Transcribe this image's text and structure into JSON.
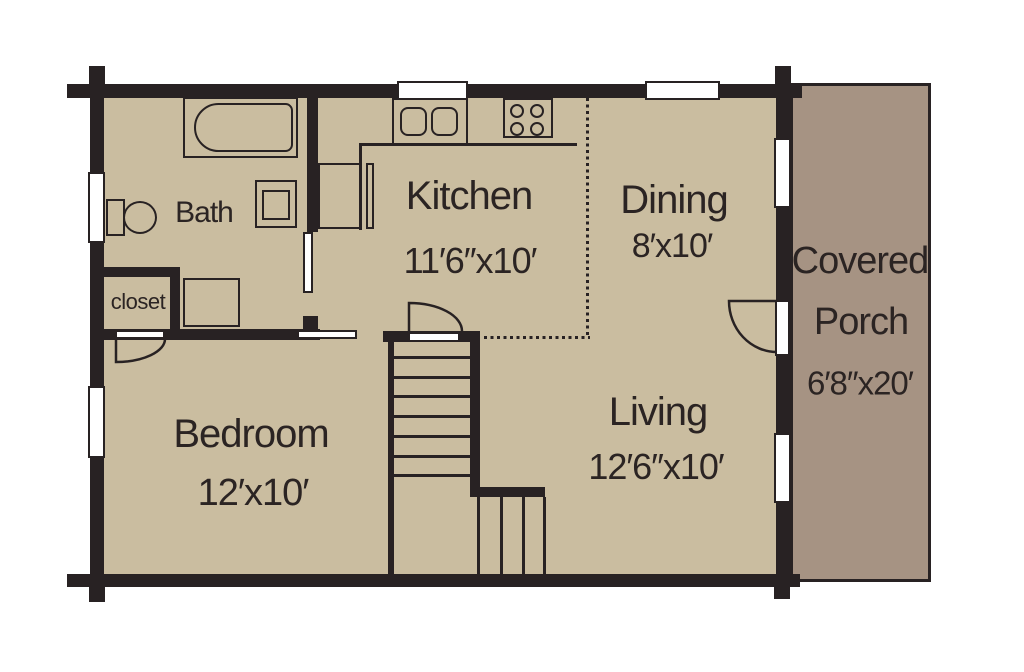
{
  "title": "Log home first floor plan",
  "colors": {
    "floor": "#cabda0",
    "porch": "#a69383",
    "wall": "#282223",
    "text": "#2b2423",
    "opening": "#ffffff"
  },
  "rooms": {
    "bath": {
      "name": "Bath"
    },
    "closet": {
      "name": "closet"
    },
    "kitchen": {
      "name": "Kitchen",
      "dims": "11′6″x10′"
    },
    "dining": {
      "name": "Dining",
      "dims": "8′x10′"
    },
    "living": {
      "name": "Living",
      "dims": "12′6″x10′"
    },
    "bedroom": {
      "name": "Bedroom",
      "dims": "12′x10′"
    },
    "porch": {
      "line1": "Covered",
      "line2": "Porch",
      "dims": "6′8″x20′"
    }
  },
  "fixtures": [
    "bathtub",
    "toilet",
    "vanity-sink",
    "linen-cabinet",
    "refrigerator",
    "kitchen-sink",
    "stove",
    "stairs"
  ],
  "window_count": 6,
  "door_count": 5
}
